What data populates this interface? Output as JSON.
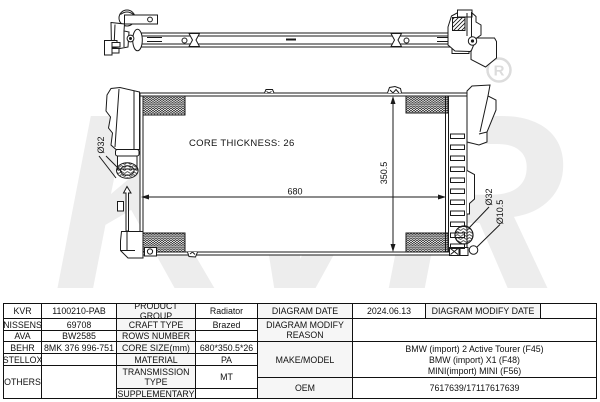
{
  "watermark": {
    "brand": "KVR",
    "registered": "R"
  },
  "diagram": {
    "core_thickness_label": "CORE THICKNESS: 26",
    "dim_width": "680",
    "dim_height": "350.5",
    "inlet_diameter": "Ø32",
    "outlet_diameter": "Ø32",
    "drain_diameter": "Ø10.5"
  },
  "table": {
    "brands": {
      "kvr": {
        "label": "KVR",
        "value": "1100210-PAB"
      },
      "nissens": {
        "label": "NISSENS",
        "value": "69708"
      },
      "ava": {
        "label": "AVA",
        "value": "BW2585"
      },
      "behr": {
        "label": "BEHR",
        "value": "8MK 376 996-751"
      },
      "stellox": {
        "label": "STELLOX",
        "value": ""
      },
      "others": {
        "label": "OTHERS",
        "value": ""
      }
    },
    "specs": {
      "product_group": {
        "label": "PRODUCT GROUP",
        "value": "Radiator"
      },
      "craft_type": {
        "label": "CRAFT TYPE",
        "value": "Brazed"
      },
      "rows_number": {
        "label": "ROWS NUMBER",
        "value": ""
      },
      "core_size": {
        "label": "CORE SIZE(mm)",
        "value": "680*350.5*26"
      },
      "material": {
        "label": "MATERIAL",
        "value": "PA"
      },
      "transmission_type": {
        "label": "TRANSMISSION TYPE",
        "value": "MT"
      },
      "supplementary": {
        "label": "SUPPLEMENTARY",
        "value": ""
      }
    },
    "info": {
      "diagram_date": {
        "label": "DIAGRAM DATE",
        "value": "2024.06.13"
      },
      "diagram_modify_date": {
        "label": "DIAGRAM MODIFY DATE",
        "value": ""
      },
      "diagram_modify_reason": {
        "label": "DIAGRAM MODIFY REASON",
        "value": ""
      },
      "make_model": {
        "label": "MAKE/MODEL",
        "values": [
          "BMW (import) 2 Active Tourer (F45)",
          "BMW (import) X1 (F48)",
          "MINI(import) MINI (F56)"
        ]
      },
      "oem": {
        "label": "OEM",
        "value": "7617639/17117617639"
      }
    }
  }
}
